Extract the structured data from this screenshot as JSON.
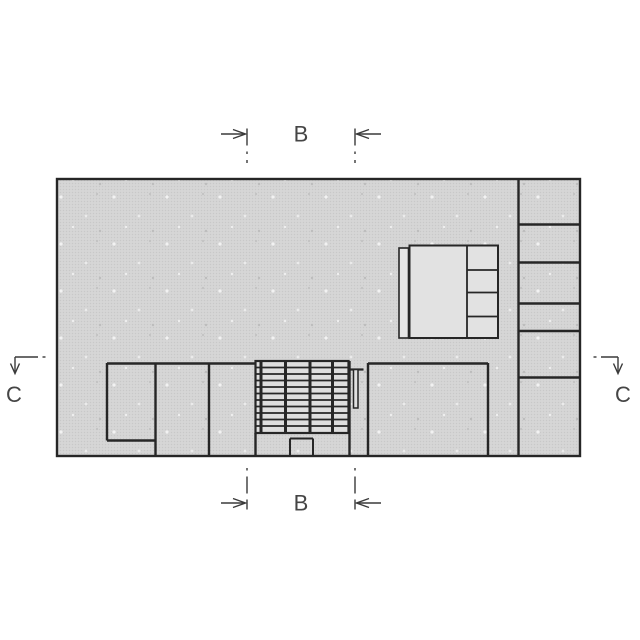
{
  "plan": {
    "markers": {
      "b_top": {
        "label": "B"
      },
      "b_bottom": {
        "label": "B"
      },
      "c_left": {
        "label": "C"
      },
      "c_right": {
        "label": "C"
      }
    },
    "colors": {
      "background": "#ffffff",
      "floor_hatch": "#d4d4d4",
      "wall_line": "#262626",
      "marker_line": "#3a3a3a",
      "label_text": "#454545",
      "furniture_fill": "#e2e2e2",
      "stair_fill": "#dedede"
    }
  }
}
